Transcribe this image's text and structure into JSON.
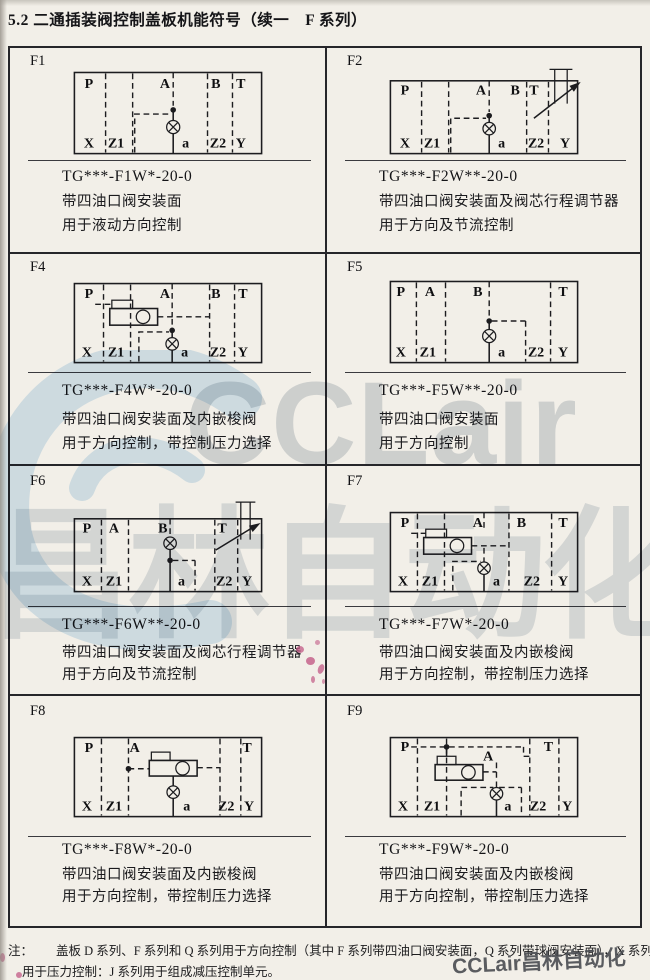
{
  "page": {
    "title": "5.2 二通插装阀控制盖板机能符号（续一　F 系列）"
  },
  "note": {
    "label": "注：",
    "line1": "盖板 D 系列、F 系列和 Q 系列用于方向控制（其中 F 系列带四油口阀安装面，Q 系列带球阀安装面），X 系列",
    "line2": "用于压力控制：J 系列用于组成减压控制单元。"
  },
  "watermark": {
    "brand_latin": "CCLair",
    "brand_cn": "昌林自动化",
    "corner_text": "CCLair昌林自动化"
  },
  "colors": {
    "paper": "#f2efe8",
    "ink": "#1c1c1f",
    "table_border": "#26262a",
    "watermark_gray": "#c0c9d1",
    "watermark_blue": "#cfe4f4",
    "stamp_pink": "#c25a85"
  },
  "cells": [
    {
      "id": "F1",
      "code": "TG***-F1W*-20-0",
      "desc1": "带四油口阀安装面",
      "desc2": "用于液动方向控制",
      "ports": [
        "P",
        "A",
        "B",
        "T",
        "X",
        "Z1",
        "a",
        "Z2",
        "Y"
      ]
    },
    {
      "id": "F2",
      "code": "TG***-F2W**-20-0",
      "desc1": "带四油口阀安装面及阀芯行程调节器",
      "desc2": "用于方向及节流控制",
      "ports": [
        "P",
        "A",
        "B",
        "T",
        "X",
        "Z1",
        "a",
        "Z2",
        "Y"
      ]
    },
    {
      "id": "F4",
      "code": "TG***-F4W*-20-0",
      "desc1": "带四油口阀安装面及内嵌梭阀",
      "desc2": "用于方向控制，带控制压力选择",
      "ports": [
        "P",
        "A",
        "B",
        "T",
        "X",
        "Z1",
        "a",
        "Z2",
        "Y"
      ]
    },
    {
      "id": "F5",
      "code": "TG***-F5W**-20-0",
      "desc1": "带四油口阀安装面",
      "desc2": "用于方向控制",
      "ports": [
        "P",
        "A",
        "B",
        "T",
        "X",
        "Z1",
        "a",
        "Z2",
        "Y"
      ]
    },
    {
      "id": "F6",
      "code": "TG***-F6W**-20-0",
      "desc1": "带四油口阀安装面及阀芯行程调节器",
      "desc2": "用于方向及节流控制",
      "ports": [
        "P",
        "A",
        "B",
        "T",
        "X",
        "Z1",
        "a",
        "Z2",
        "Y"
      ]
    },
    {
      "id": "F7",
      "code": "TG***-F7W*-20-0",
      "desc1": "带四油口阀安装面及内嵌梭阀",
      "desc2": "用于方向控制，带控制压力选择",
      "ports": [
        "P",
        "A",
        "B",
        "T",
        "X",
        "Z1",
        "a",
        "Z2",
        "Y"
      ]
    },
    {
      "id": "F8",
      "code": "TG***-F8W*-20-0",
      "desc1": "带四油口阀安装面及内嵌梭阀",
      "desc2": "用于方向控制，带控制压力选择",
      "ports": [
        "P",
        "A",
        "T",
        "X",
        "Z1",
        "a",
        "Z2",
        "Y"
      ]
    },
    {
      "id": "F9",
      "code": "TG***-F9W*-20-0",
      "desc1": "带四油口阀安装面及内嵌梭阀",
      "desc2": "用于方向控制，带控制压力选择",
      "ports": [
        "P",
        "A",
        "T",
        "X",
        "Z1",
        "a",
        "Z2",
        "Y"
      ]
    }
  ]
}
